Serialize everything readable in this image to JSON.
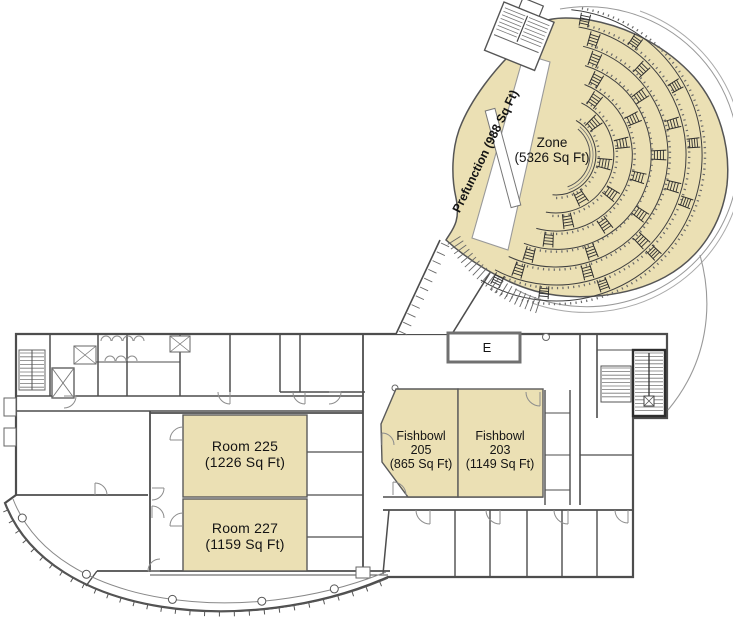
{
  "plan": {
    "auditorium": {
      "zone_name": "Zone",
      "zone_area": "(5326 Sq Ft)",
      "prefunction_label": "Prefunction (988 Sq Ft)"
    },
    "rooms": {
      "room225_name": "Room 225",
      "room225_area": "(1226 Sq Ft)",
      "room227_name": "Room 227",
      "room227_area": "(1159 Sq Ft)",
      "fishbowl205_name": "Fishbowl",
      "fishbowl205_number": "205",
      "fishbowl205_area": "(865 Sq Ft)",
      "fishbowl203_name": "Fishbowl",
      "fishbowl203_number": "203",
      "fishbowl203_area": "(1149 Sq Ft)",
      "elevator_label": "E"
    },
    "colors": {
      "highlight": "#EBE0B4",
      "wall": "#4d4d4d",
      "wall_light": "#8c8c8c",
      "text": "#141414"
    }
  }
}
